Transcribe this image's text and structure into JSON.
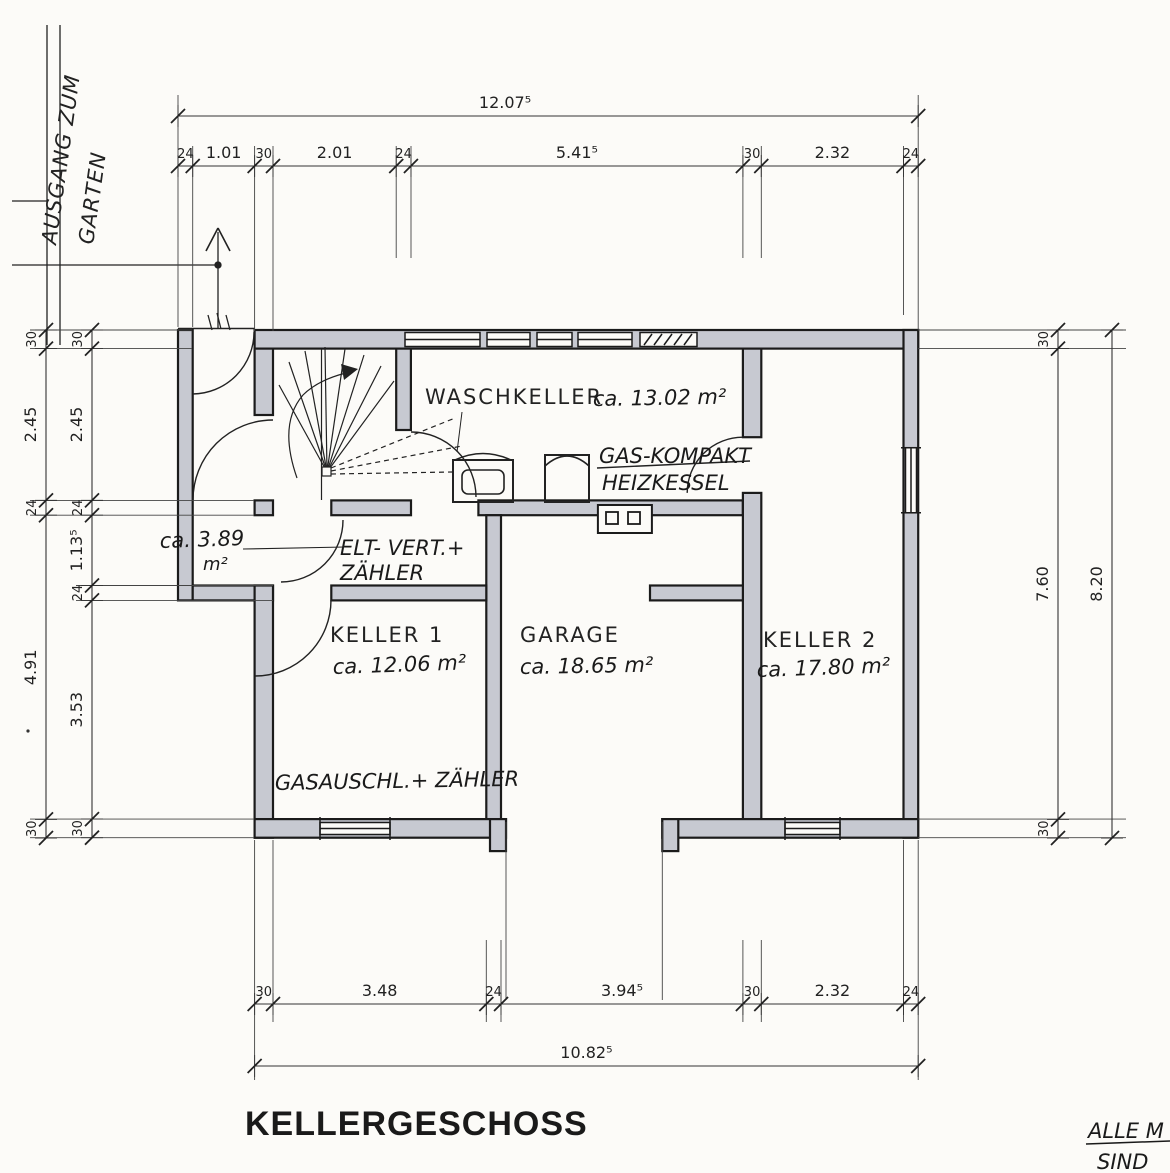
{
  "title": "KELLERGESCHOSS",
  "garden_label": {
    "line1": "AUSGANG ZUM",
    "line2": "GARTEN"
  },
  "corner_note": {
    "line1": "ALLE M",
    "line2": "SIND"
  },
  "rooms": {
    "waschkeller": {
      "name": "WASCHKELLER",
      "area": "ca. 13.02 m²"
    },
    "heizung": {
      "line1": "GAS-KOMPAKT",
      "line2": "HEIZKESSEL"
    },
    "elt": {
      "line1": "ELT- VERT.+",
      "line2": "ZÄHLER"
    },
    "hall": {
      "area": "ca. 3.89",
      "unit": "m²"
    },
    "keller1": {
      "name": "KELLER 1",
      "area": "ca. 12.06 m²"
    },
    "garage": {
      "name": "GARAGE",
      "area": "ca. 18.65 m²"
    },
    "keller2": {
      "name": "KELLER 2",
      "area": "ca. 17.80 m²"
    },
    "gas": {
      "label": "GASAUSCHL.+ ZÄHLER"
    }
  },
  "dimensions": {
    "top_total": {
      "label": "12.07⁵",
      "m": 12.075
    },
    "top_segments": [
      {
        "label": "24",
        "m": 0.24
      },
      {
        "label": "1.01",
        "m": 1.01
      },
      {
        "label": "30",
        "m": 0.3
      },
      {
        "label": "2.01",
        "m": 2.01
      },
      {
        "label": "24",
        "m": 0.24
      },
      {
        "label": "5.41⁵",
        "m": 5.415
      },
      {
        "label": "30",
        "m": 0.3
      },
      {
        "label": "2.32",
        "m": 2.32
      },
      {
        "label": "24",
        "m": 0.24
      }
    ],
    "left_outer": [
      {
        "label": "30",
        "m": 0.3
      },
      {
        "label": "2.45",
        "m": 2.45
      },
      {
        "label": "24",
        "m": 0.24
      },
      {
        "label": "4.91",
        "m": 4.91
      },
      {
        "label": "30",
        "m": 0.3
      }
    ],
    "left_inner": [
      {
        "label": "30",
        "m": 0.3
      },
      {
        "label": "2.45",
        "m": 2.45
      },
      {
        "label": "24",
        "m": 0.24
      },
      {
        "label": "1.13⁵",
        "m": 1.135
      },
      {
        "label": "24",
        "m": 0.24
      },
      {
        "label": "3.53",
        "m": 3.53
      },
      {
        "label": "30",
        "m": 0.3
      }
    ],
    "right_inner": [
      {
        "label": "30",
        "m": 0.3
      },
      {
        "label": "7.60",
        "m": 7.6
      },
      {
        "label": "30",
        "m": 0.3
      }
    ],
    "right_outer_total": {
      "label": "8.20",
      "m": 8.2
    },
    "bottom_segments": [
      {
        "label": "30",
        "m": 0.3
      },
      {
        "label": "3.48",
        "m": 3.48
      },
      {
        "label": "24",
        "m": 0.24
      },
      {
        "label": "3.94⁵",
        "m": 3.945
      },
      {
        "label": "30",
        "m": 0.3
      },
      {
        "label": "2.32",
        "m": 2.32
      },
      {
        "label": "24",
        "m": 0.24
      }
    ],
    "bottom_total": {
      "label": "10.82⁵",
      "m": 10.825
    }
  }
}
